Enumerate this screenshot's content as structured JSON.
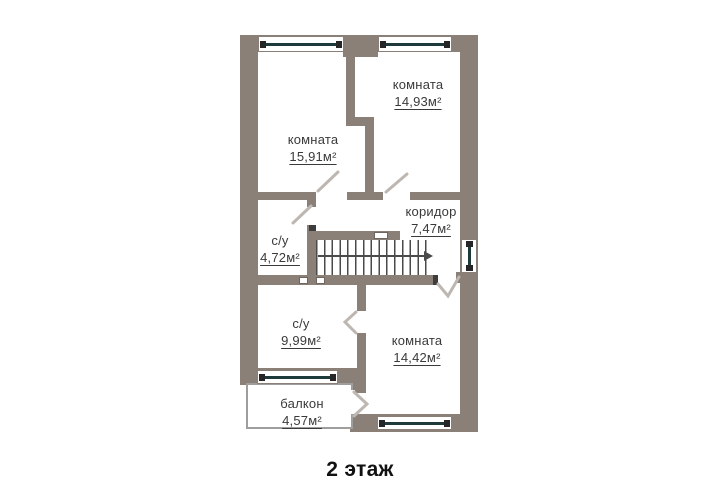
{
  "floor_plan": {
    "caption": "2 этаж",
    "rooms": [
      {
        "name": "комната",
        "area": "15,91м²"
      },
      {
        "name": "комната",
        "area": "14,93м²"
      },
      {
        "name": "коридор",
        "area": "7,47м²"
      },
      {
        "name": "с/у",
        "area": "4,72м²"
      },
      {
        "name": "с/у",
        "area": "9,99м²"
      },
      {
        "name": "комната",
        "area": "14,42м²"
      },
      {
        "name": "балкон",
        "area": "4,57м²"
      }
    ],
    "icons": {
      "stairs_direction": "arrow-right",
      "vent_shaft": "small-white-square"
    },
    "colors": {
      "wall": "#8a8078",
      "balcony_wall": "#9e9e9e",
      "window_glass": "#1e3a3a",
      "window_cap": "#262626",
      "stair_tread": "#4a4a4a",
      "door_leaf": "#beb7b1",
      "label_text": "#3a3a3a",
      "caption_text": "#111111",
      "background": "#ffffff"
    }
  }
}
